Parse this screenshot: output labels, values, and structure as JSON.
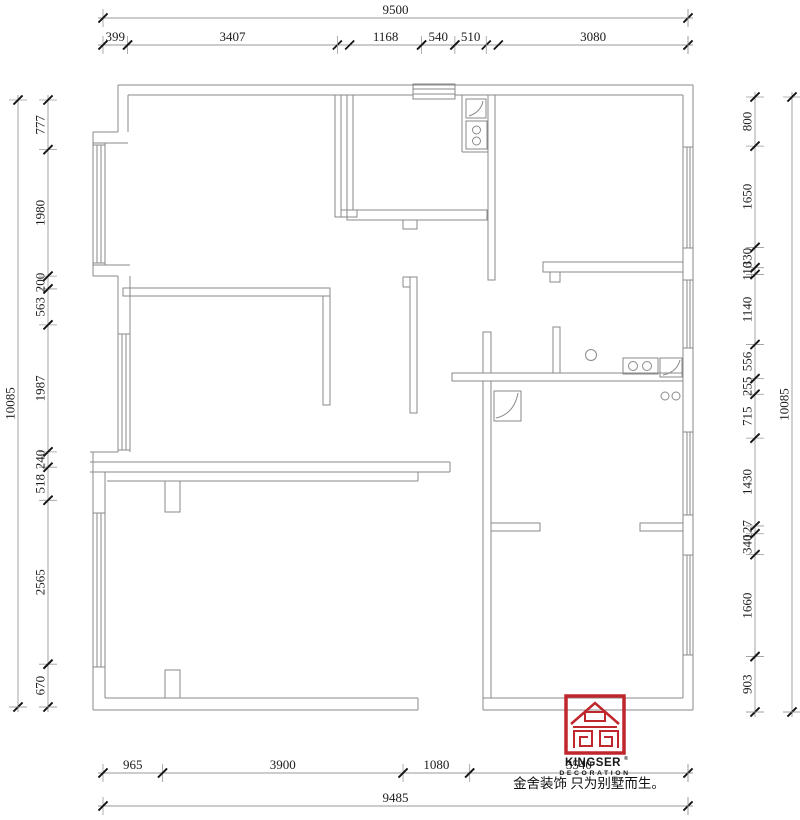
{
  "drawing": {
    "type": "residential floor plan",
    "wall_color": "#8a8a8a",
    "tick_color": "#151515",
    "background": "#ffffff"
  },
  "dimensions": {
    "top_overall": [
      9500
    ],
    "top_chain": [
      399,
      3407,
      1168,
      540,
      510,
      3080
    ],
    "left_overall": [
      10085
    ],
    "left_chain": [
      777,
      1980,
      200,
      563,
      1987,
      240,
      518,
      2565,
      670
    ],
    "right_overall": [
      10085
    ],
    "right_chain": [
      800,
      1650,
      330,
      110,
      1140,
      556,
      255,
      715,
      1430,
      127,
      340,
      1660,
      903
    ],
    "bottom_chain": [
      965,
      3900,
      1080,
      3540
    ],
    "bottom_overall": [
      9485
    ]
  },
  "logo": {
    "brand": "KINGSER",
    "registered": "®",
    "subtitle": "DECORATION",
    "tagline": "金舍装饰 只为别墅而生。",
    "accent_color": "#c0272d"
  }
}
